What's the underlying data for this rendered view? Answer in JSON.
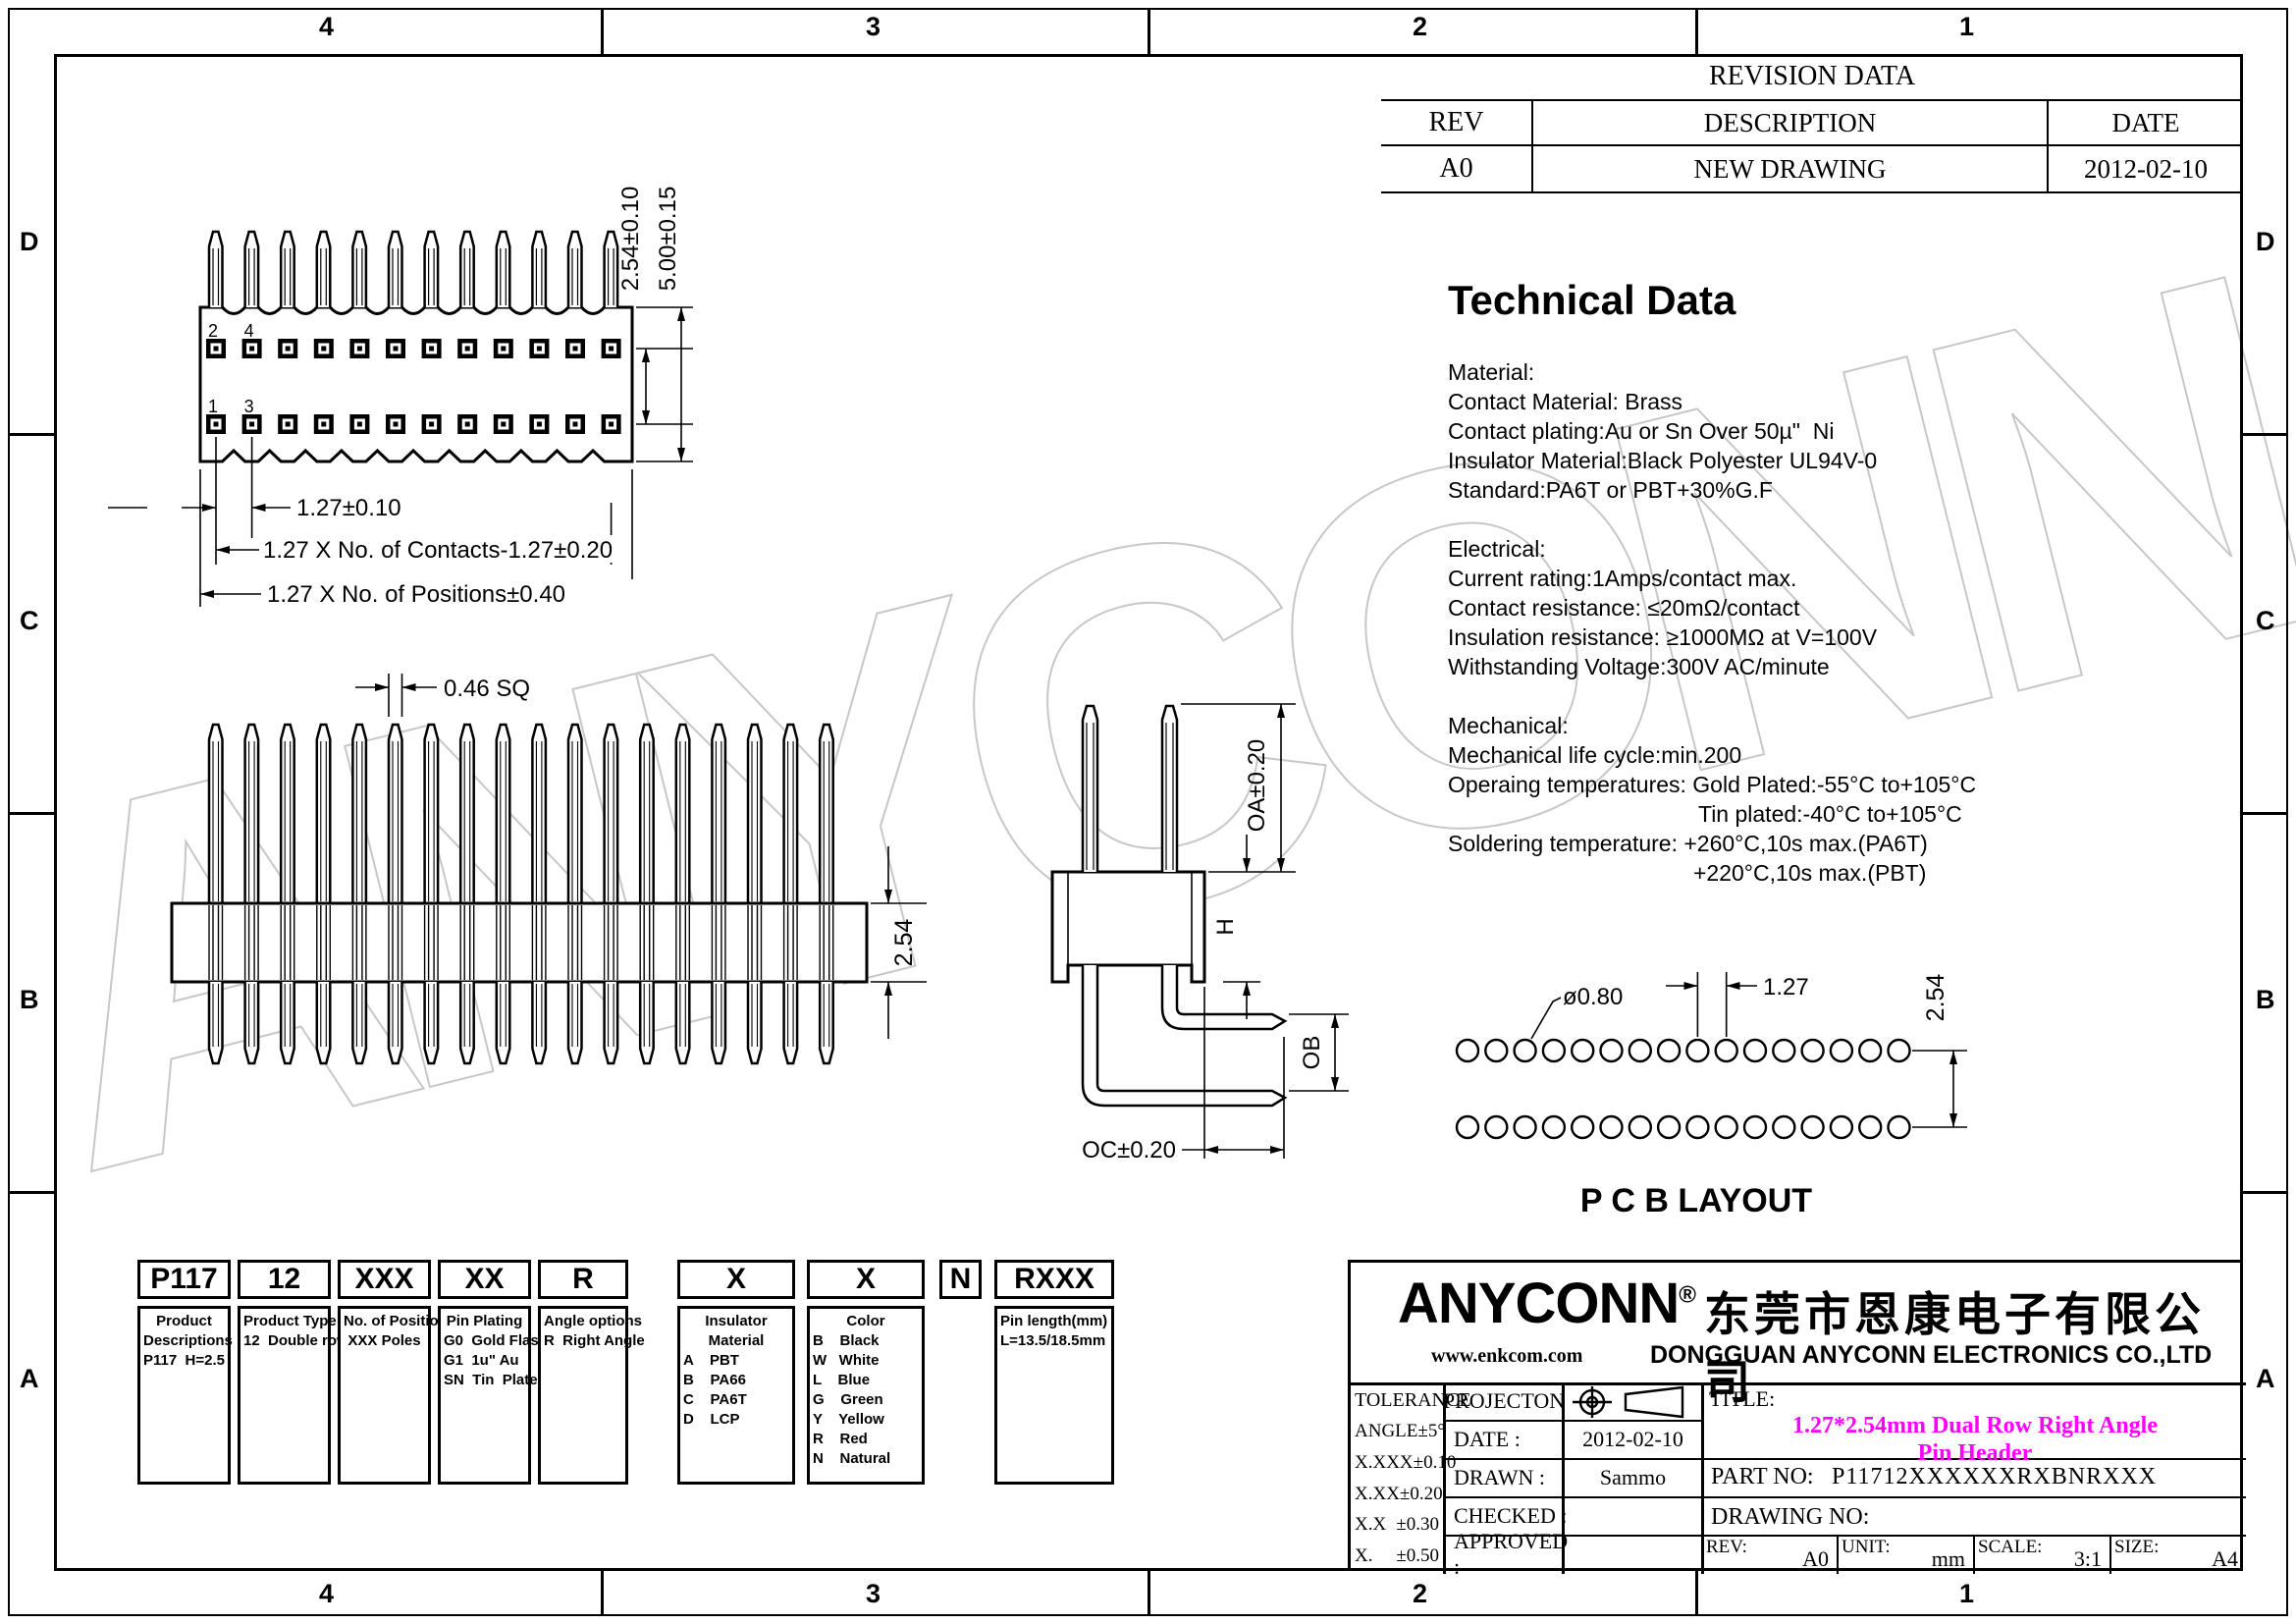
{
  "zones": {
    "top": [
      "4",
      "3",
      "2",
      "1"
    ],
    "bottom": [
      "4",
      "3",
      "2",
      "1"
    ],
    "left": [
      "D",
      "C",
      "B",
      "A"
    ],
    "right": [
      "D",
      "C",
      "B",
      "A"
    ]
  },
  "revision_table": {
    "title": "REVISION DATA",
    "headers": [
      "REV",
      "DESCRIPTION",
      "DATE"
    ],
    "rows": [
      [
        "A0",
        "NEW DRAWING",
        "2012-02-10"
      ]
    ]
  },
  "technical_data": {
    "title": "Technical Data",
    "lines": [
      {
        "t": "Material:"
      },
      {
        "t": "Contact Material: Brass"
      },
      {
        "t": "Contact plating:Au or Sn Over 50µ\"  Ni"
      },
      {
        "t": "Insulator Material:Black Polyester UL94V-0"
      },
      {
        "t": "Standard:PA6T or PBT+30%G.F"
      },
      {
        "t": "",
        "gap": 1
      },
      {
        "t": "Electrical:"
      },
      {
        "t": "Current rating:1Amps/contact max."
      },
      {
        "t": "Contact resistance: ≤20mΩ/contact"
      },
      {
        "t": "Insulation resistance: ≥1000MΩ at V=100V"
      },
      {
        "t": "Withstanding Voltage:300V AC/minute"
      },
      {
        "t": "",
        "gap": 1
      },
      {
        "t": "Mechanical:"
      },
      {
        "t": "Mechanical life cycle:min.200"
      },
      {
        "t": "Operaing temperatures: Gold Plated:-55°C to+105°C"
      },
      {
        "t": "Tin plated:-40°C to+105°C",
        "indent": 1
      },
      {
        "t": "Soldering temperature: +260°C,10s max.(PA6T)"
      },
      {
        "t": "+220°C,10s max.(PBT)",
        "indent": 2
      }
    ]
  },
  "dimensions": {
    "top_view": {
      "row_pitch": "2.54±0.10",
      "body_height": "5.00±0.15",
      "pin_pitch": "1.27±0.10",
      "contacts": "1.27  X  No.  of  Contacts-1.27±0.20",
      "positions": "1.27  X  No.  of  Positions±0.40",
      "pin_square": "0.46  SQ",
      "pin_numbers": [
        "2",
        "4",
        "1",
        "3"
      ]
    },
    "front_view": {
      "row_pitch": "2.54"
    },
    "side_view": {
      "oa": "OA±0.20",
      "h": "H",
      "ob": "OB",
      "oc": "OC±0.20"
    },
    "pcb": {
      "hole": "ø0.80",
      "pitch": "1.27",
      "row_pitch": "2.54",
      "caption": "P C B LAYOUT"
    }
  },
  "drawing_counts": {
    "top_view_pins": 12,
    "front_view_pins": 18,
    "pcb_cols": 16,
    "pcb_rows": 2
  },
  "part_number": {
    "columns": [
      {
        "code": "P117",
        "lines": [
          {
            "t": "Product",
            "c": 1
          },
          {
            "t": "Descriptions",
            "c": 1
          },
          {
            "t": "P117  H=2.5"
          }
        ]
      },
      {
        "code": "12",
        "lines": [
          {
            "t": "Product Type",
            "c": 1
          },
          {
            "t": "12  Double row"
          }
        ]
      },
      {
        "code": "XXX",
        "lines": [
          {
            "t": "No. of Positions",
            "c": 1
          },
          {
            "t": "XXX Poles",
            "c": 1
          }
        ]
      },
      {
        "code": "XX",
        "lines": [
          {
            "t": "Pin Plating",
            "c": 1
          },
          {
            "t": "G0  Gold Flash"
          },
          {
            "t": "G1  1u\" Au"
          },
          {
            "t": "SN  Tin  Plated"
          }
        ]
      },
      {
        "code": "R",
        "lines": [
          {
            "t": "Angle options",
            "c": 1
          },
          {
            "t": "R  Right Angle"
          }
        ]
      },
      {
        "code": "X",
        "lines": [
          {
            "t": "Insulator",
            "c": 1
          },
          {
            "t": "Material",
            "c": 1
          },
          {
            "t": "A    PBT"
          },
          {
            "t": "B    PA66"
          },
          {
            "t": "C    PA6T"
          },
          {
            "t": "D    LCP"
          }
        ]
      },
      {
        "code": "X",
        "lines": [
          {
            "t": "Color",
            "c": 1
          },
          {
            "t": "B    Black"
          },
          {
            "t": "W   White"
          },
          {
            "t": "L    Blue"
          },
          {
            "t": "G    Green"
          },
          {
            "t": "Y    Yellow"
          },
          {
            "t": "R    Red"
          },
          {
            "t": "N    Natural"
          }
        ]
      },
      {
        "code": "N",
        "lines": []
      },
      {
        "code": "RXXX",
        "lines": [
          {
            "t": "Pin length(mm)"
          },
          {
            "t": "L=13.5/18.5mm"
          }
        ]
      }
    ]
  },
  "title_block": {
    "logo": "ANYCONN",
    "logo_reg": "®",
    "company_cn": "东莞市恩康电子有限公司",
    "website": "www.enkcom.com",
    "company_en": "DONGGUAN  ANYCONN  ELECTRONICS  CO.,LTD",
    "tolerance_title": "TOLERANCE",
    "tolerances": [
      [
        "ANGLE",
        "±5°"
      ],
      [
        "X.XXX",
        "±0.10"
      ],
      [
        "X.XX",
        "±0.20"
      ],
      [
        "X.X",
        "±0.30"
      ],
      [
        "X.",
        "±0.50"
      ]
    ],
    "projection_label": "PROJECTON",
    "rows": [
      {
        "label": "DATE :",
        "value": "2012-02-10"
      },
      {
        "label": "DRAWN :",
        "value": "Sammo"
      },
      {
        "label": "CHECKED :",
        "value": ""
      },
      {
        "label": "APPROVED :",
        "value": ""
      }
    ],
    "title_label": "TITLE:",
    "title_line1": "1.27*2.54mm  Dual Row Right Angle",
    "title_line2": "Pin Header",
    "part_no_label": "PART NO:",
    "part_no": "P11712XXXXXXRXBNRXXX",
    "drawing_no_label": "DRAWING NO:",
    "rev_label": "REV:",
    "rev": "A0",
    "unit_label": "UNIT:",
    "unit": "mm",
    "scale_label": "SCALE:",
    "scale": "3:1",
    "size_label": "SIZE:",
    "size": "A4"
  },
  "watermark": "ANYCONN"
}
